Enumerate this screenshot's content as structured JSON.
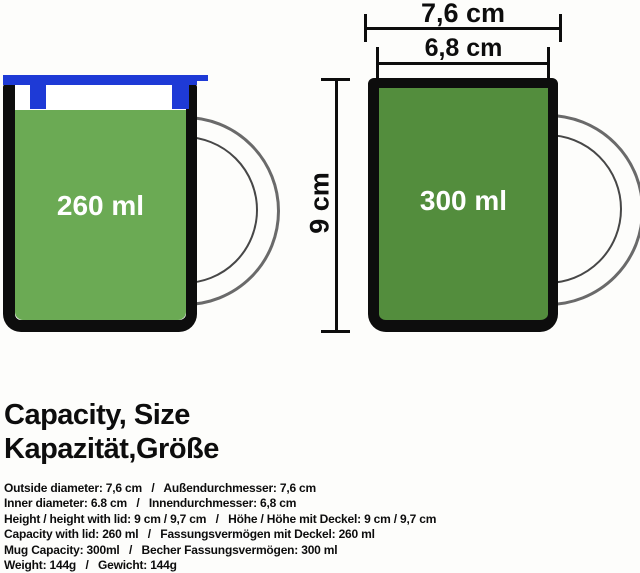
{
  "diagram": {
    "dim_outside_label": "7,6 cm",
    "dim_inner_label": "6,8 cm",
    "dim_height_label": "9 cm",
    "left_mug": {
      "capacity_label": "260 ml"
    },
    "right_mug": {
      "capacity_label": "300 ml"
    }
  },
  "title": {
    "en": "Capacity, Size",
    "de": "Kapazität,Größe"
  },
  "specs": [
    "Outside diameter: 7,6 cm   /   Außendurchmesser: 7,6 cm",
    "Inner diameter: 6.8 cm   /   Innendurchmesser: 6,8 cm",
    "Height / height with lid: 9 cm / 9,7 cm   /   Höhe / Höhe mit Deckel: 9 cm / 9,7 cm",
    "Capacity with lid: 260 ml   /   Fassungsvermögen mit Deckel: 260 ml",
    "Mug Capacity: 300ml   /   Becher Fassungsvermögen: 300 ml",
    "Weight: 144g   /   Gewicht: 144g"
  ],
  "colors": {
    "background": "#fdfdfb",
    "left_mug_green": "#6BAA54",
    "right_mug_green": "#538D3D",
    "lid_blue": "#1E3AD6",
    "outline_black": "#0d0d0d",
    "handle_outer_gray": "#6a6a6a",
    "handle_inner_gray": "#474747",
    "capacity_text_white": "#ffffff"
  }
}
